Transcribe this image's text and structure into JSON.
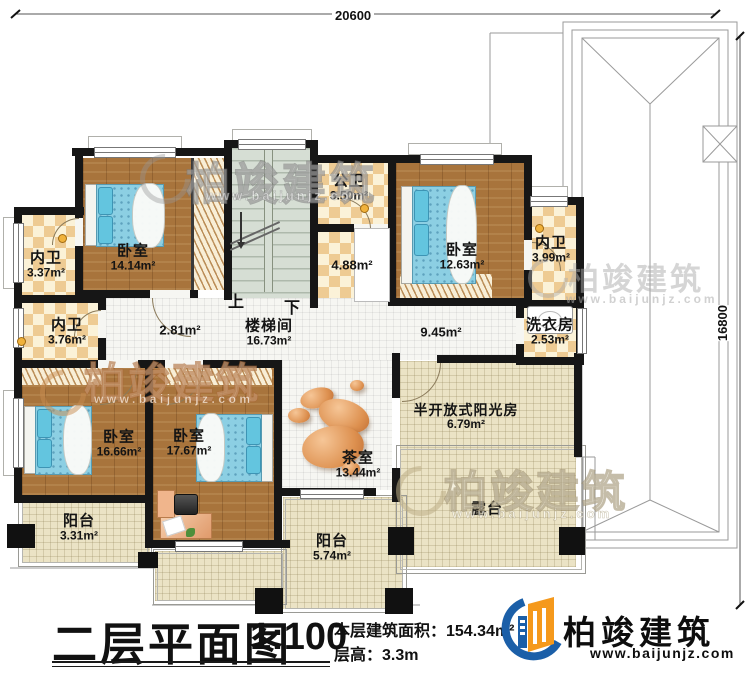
{
  "dimensions": {
    "top": "20600",
    "right": "16800"
  },
  "stair_labels": {
    "up": "上",
    "down": "下"
  },
  "rooms": {
    "bath_a": {
      "name": "内卫",
      "area": "3.37m²"
    },
    "bath_b": {
      "name": "内卫",
      "area": "3.76m²"
    },
    "bath_c": {
      "name": "内卫",
      "area": "3.99m²"
    },
    "bed1": {
      "name": "卧室",
      "area": "14.14m²"
    },
    "bed2": {
      "name": "卧室",
      "area": "12.63m²"
    },
    "bed3": {
      "name": "卧室",
      "area": "16.66m²"
    },
    "bed4": {
      "name": "卧室",
      "area": "17.67m²"
    },
    "public_bath": {
      "name": "公卫",
      "area": "3.50m²"
    },
    "basin": {
      "area": "4.88m²"
    },
    "stairwell": {
      "name": "楼梯间",
      "area": "16.73m²"
    },
    "hall_small": {
      "area": "2.81m²"
    },
    "hall": {
      "area": "9.45m²"
    },
    "laundry": {
      "name": "洗衣房",
      "area": "2.53m²"
    },
    "tea": {
      "name": "茶室",
      "area": "13.44m²"
    },
    "sunroom": {
      "name": "半开放式阳光房",
      "area": "6.79m²"
    },
    "terrace": {
      "name": "露台"
    },
    "balcony1": {
      "name": "阳台",
      "area": "3.31m²"
    },
    "balcony2": {
      "name": "阳台",
      "area": "5.74m²"
    }
  },
  "title_block": {
    "title": "二层平面图",
    "scale": "1:100",
    "area_line": "本层建筑面积：154.34m²",
    "height_line": "层高：3.3m"
  },
  "brand": {
    "name": "柏竣建筑",
    "url": "www.baijunjz.com",
    "blue": "#1b5fa8",
    "orange": "#f5991c"
  },
  "watermark": {
    "name": "柏竣建筑",
    "url": "www.baijunjz.com"
  }
}
